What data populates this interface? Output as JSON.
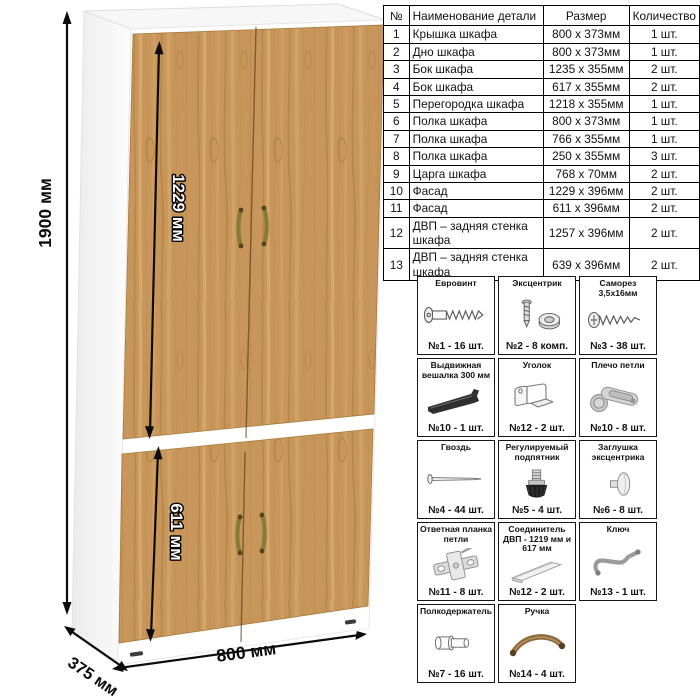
{
  "dimensions": {
    "height": "1900 мм",
    "upper_door": "1229 мм",
    "lower_door": "611 мм",
    "depth": "375 мм",
    "width": "800 мм"
  },
  "parts_table": {
    "headers": [
      "№",
      "Наименование детали",
      "Размер",
      "Количество"
    ],
    "rows": [
      {
        "num": "1",
        "name": "Крышка шкафа",
        "size": "800 x 373мм",
        "qty": "1 шт."
      },
      {
        "num": "2",
        "name": "Дно шкафа",
        "size": "800 x 373мм",
        "qty": "1 шт."
      },
      {
        "num": "3",
        "name": "Бок шкафа",
        "size": "1235 x 355мм",
        "qty": "2 шт."
      },
      {
        "num": "4",
        "name": "Бок шкафа",
        "size": "617 x 355мм",
        "qty": "2 шт."
      },
      {
        "num": "5",
        "name": "Перегородка шкафа",
        "size": "1218 x 355мм",
        "qty": "1 шт."
      },
      {
        "num": "6",
        "name": "Полка шкафа",
        "size": "800 x 373мм",
        "qty": "1 шт."
      },
      {
        "num": "7",
        "name": "Полка шкафа",
        "size": "766 x 355мм",
        "qty": "1 шт."
      },
      {
        "num": "8",
        "name": "Полка шкафа",
        "size": "250 x 355мм",
        "qty": "3 шт."
      },
      {
        "num": "9",
        "name": "Царга шкафа",
        "size": "768 x 70мм",
        "qty": "2 шт."
      },
      {
        "num": "10",
        "name": "Фасад",
        "size": "1229 x 396мм",
        "qty": "2 шт."
      },
      {
        "num": "11",
        "name": "Фасад",
        "size": "611 x 396мм",
        "qty": "2 шт."
      },
      {
        "num": "12",
        "name": "ДВП – задняя стенка шкафа",
        "size": "1257 x 396мм",
        "qty": "2 шт."
      },
      {
        "num": "13",
        "name": "ДВП – задняя стенка шкафа",
        "size": "639 x 396мм",
        "qty": "2 шт."
      }
    ]
  },
  "hardware": {
    "items": [
      {
        "title": "Евровинт",
        "count": "№1 - 16 шт.",
        "icon": "euro-screw-icon"
      },
      {
        "title": "Эксцентрик",
        "count": "№2 - 8 комп.",
        "icon": "eccentric-cam-icon"
      },
      {
        "title": "Саморез 3,5x16мм",
        "count": "№3 - 38 шт.",
        "icon": "self-tapping-screw-icon"
      },
      {
        "title": "Выдвижная вешалка 300 мм",
        "count": "№10 - 1 шт.",
        "icon": "pull-out-hanger-icon"
      },
      {
        "title": "Уголок",
        "count": "№12 - 2 шт.",
        "icon": "corner-bracket-icon"
      },
      {
        "title": "Плечо петли",
        "count": "№10 - 8 шт.",
        "icon": "hinge-arm-icon"
      },
      {
        "title": "Гвоздь",
        "count": "№4 - 44 шт.",
        "icon": "nail-icon"
      },
      {
        "title": "Регулируемый подпятник",
        "count": "№5 - 4 шт.",
        "icon": "adjustable-foot-icon"
      },
      {
        "title": "Заглушка эксцентрика",
        "count": "№6 - 8 шт.",
        "icon": "cam-cap-icon"
      },
      {
        "title": "Ответная планка петли",
        "count": "№11 - 8 шт.",
        "icon": "hinge-plate-icon"
      },
      {
        "title": "Соединитель ДВП - 1219 мм и 617 мм",
        "count": "№12 - 2 шт.",
        "icon": "hdf-connector-icon"
      },
      {
        "title": "Ключ",
        "count": "№13 - 1 шт.",
        "icon": "hex-key-icon"
      },
      {
        "title": "Полкодержатель",
        "count": "№7 - 16 шт.",
        "icon": "shelf-pin-icon"
      },
      {
        "title": "Ручка",
        "count": "№14 - 4 шт.",
        "icon": "handle-icon"
      }
    ]
  },
  "colors": {
    "wood_base": "#c8965a",
    "wood_grain_dark": "#a87a3c",
    "wood_grain_light": "#dcb273",
    "carcass_white": "#ffffff",
    "handle_bronze": "#867b39",
    "dimension_black": "#0c0c0c"
  }
}
